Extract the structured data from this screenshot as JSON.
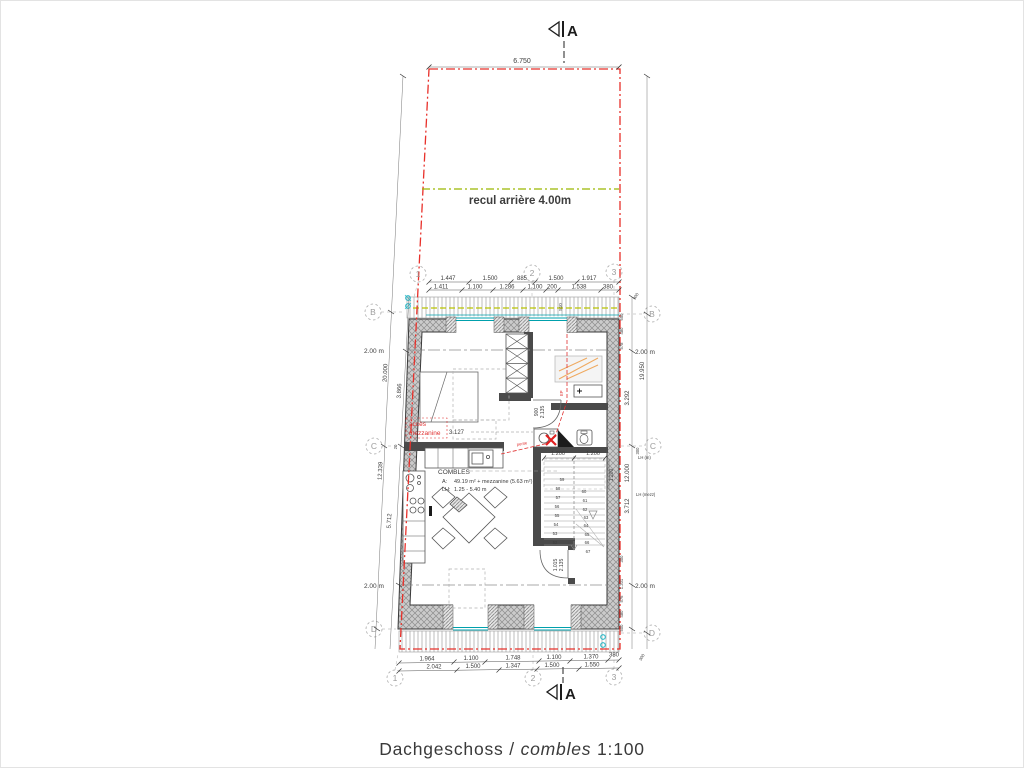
{
  "title": {
    "part1": "Dachgeschoss /",
    "part2": "combles",
    "part3": "1:100"
  },
  "section_label": "A",
  "setback_label": "recul arrière 4.00m",
  "plot_width_dim": "6.750",
  "grid": {
    "one": "1",
    "two": "2",
    "three": "3",
    "b": "B",
    "c": "C",
    "d": "D"
  },
  "dims": {
    "top1": [
      "1.447",
      "1.500",
      "885",
      "1.500",
      "1.917"
    ],
    "top2": [
      "1.411",
      "1.100",
      "1.286",
      "1.100",
      "200",
      "1.538",
      "380"
    ],
    "bot1": [
      "1.964",
      "1.100",
      "1.748",
      "1.100",
      "1.370",
      "380"
    ],
    "bot2": [
      "2.042",
      "1.500",
      "1.347",
      "1.500",
      "1.550"
    ],
    "left": {
      "l20": "20.000",
      "l3866": "3.866",
      "l12339": "12.339",
      "l5712": "5.712",
      "small20": "20",
      "h1": "2.00 m",
      "h2": "2.00 m"
    },
    "right": {
      "r19950": "19.950",
      "r3292": "3.292",
      "r12000": "12.000",
      "r3712": "3.712",
      "h1": "2.00 m",
      "h2": "2.00 m",
      "top_stack": [
        "300",
        "650",
        "480",
        "578"
      ],
      "bot_stack": [
        "300",
        "1.201",
        "576",
        "480",
        "500"
      ],
      "diag_top": "300",
      "diag_bot": "300",
      "small300": "300",
      "lh1": "LH (m)",
      "lh2": "LH (mezz)"
    },
    "stair_w1": "1.200",
    "stair_w2": "1.200",
    "stair_v": "1.200",
    "win510": "510",
    "acces_dim": "3.127",
    "door1_w": "900",
    "door1_h": "2.135",
    "door2_w": "1.015",
    "door2_h": "2.135"
  },
  "room": {
    "name": "COMBLES",
    "a_label": "A:",
    "a_value": "49.19 m² + mezzanine (5.63 m²)",
    "lh_label": "LH:",
    "lh_value": "1.25 - 5.40 m"
  },
  "red_notes": {
    "acces1": "accès",
    "acces2": "mezzanine",
    "pente": "pente",
    "ep": "EP"
  },
  "stairs": {
    "left": [
      "59",
      "58",
      "57",
      "56",
      "55",
      "54",
      "53",
      "52"
    ],
    "right": [
      "60",
      "61",
      "62",
      "63",
      "64",
      "65",
      "66",
      "67"
    ]
  },
  "colors": {
    "parcel_red": "#e8302a",
    "setback_green": "#8fad00",
    "glazing_teal": "#00a0ac",
    "roof_yellow": "#b9c400",
    "velux_orange": "#efa95f",
    "annotation_red": "#e03030",
    "downspout_cyan": "#2ab9c8"
  }
}
